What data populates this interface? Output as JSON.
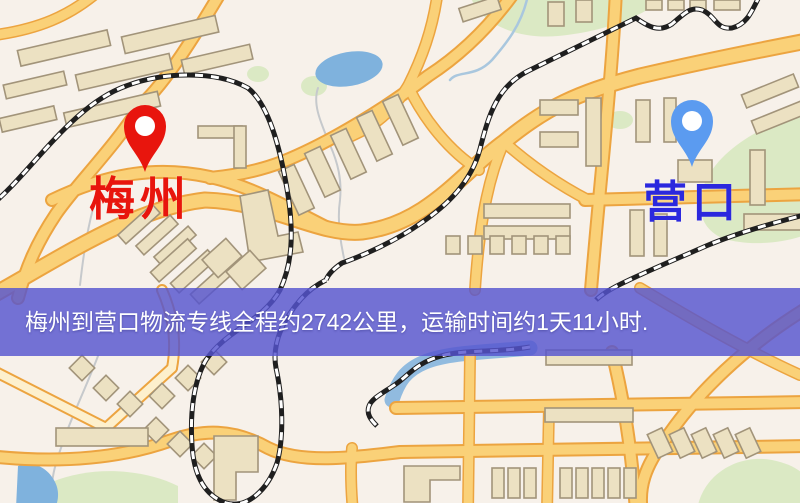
{
  "map": {
    "origin": {
      "name": "梅州"
    },
    "destination": {
      "name": "营口"
    },
    "banner": {
      "text": "梅州到营口物流专线全程约2742公里，运输时间约1天11小时."
    },
    "colors": {
      "map-bg": "#f7f1ea",
      "road-fill": "#fad178",
      "road-casing": "#eca440",
      "road-pale": "#fdf0cd",
      "building-fill": "#ece1c2",
      "building-stroke": "#a2947a",
      "water": "#7fb2dd",
      "stream": "#a9c7de",
      "park": "#dbe9c4",
      "railway": "#1f1f1f",
      "origin-pin": "#e8150d",
      "origin-label": "#e8150d",
      "destination-pin": "#5b9bf0",
      "destination-label": "#2b28de",
      "banner-bg": "#5554d0",
      "banner-text": "#ffffff"
    }
  }
}
